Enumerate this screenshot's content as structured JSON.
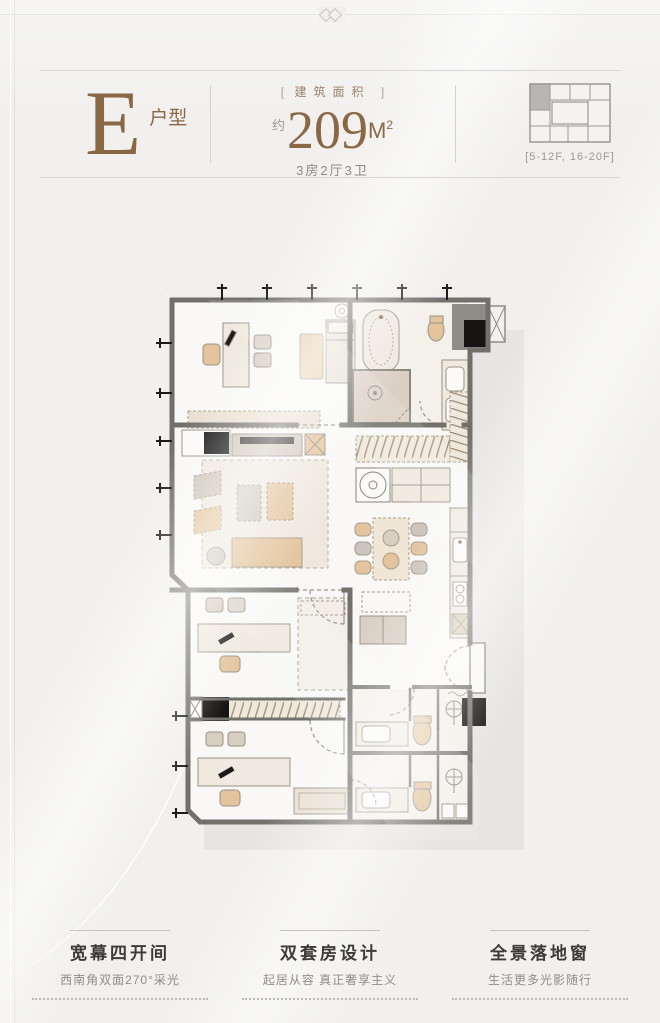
{
  "colors": {
    "background": "#f1f0ee",
    "accent_brown": "#8a6845",
    "wall_gray": "#72706b",
    "furniture_tan": "#e3c49c",
    "furniture_beige": "#e9e1d4",
    "furniture_gray": "#ccc5bd",
    "text_dark": "#3c3b39",
    "text_gray": "#8f8d8a"
  },
  "header": {
    "unit_letter": "E",
    "unit_type_label": "户型",
    "area_bracket_open": "[",
    "area_bracket_close": "]",
    "area_caption": "建筑面积",
    "area_approx": "约",
    "area_value": "209",
    "area_unit": "M",
    "area_unit_exp": "2",
    "layout_summary": "3房2厅3卫",
    "floor_range": "[5-12F, 16-20F]"
  },
  "keyplan": {
    "highlighted_unit": "top-left",
    "icon": "building-keyplan-icon"
  },
  "floorplan": {
    "icons": [
      "window-tick-icon",
      "door-arc-icon",
      "bathtub-icon",
      "shower-icon",
      "toilet-icon",
      "sink-icon",
      "washer-icon",
      "stove-icon",
      "bed-icon",
      "sofa-icon",
      "armchair-icon",
      "coffee-table-icon",
      "dining-table-icon",
      "desk-icon",
      "wardrobe-hanger-icon",
      "elevator-icon",
      "column-icon",
      "pendant-icon",
      "doormat-icon"
    ]
  },
  "features": [
    {
      "title": "宽幕四开间",
      "subtitle": "西南角双面270°采光"
    },
    {
      "title": "双套房设计",
      "subtitle": "起居从容 真正奢享主义"
    },
    {
      "title": "全景落地窗",
      "subtitle": "生活更多光影随行"
    }
  ]
}
